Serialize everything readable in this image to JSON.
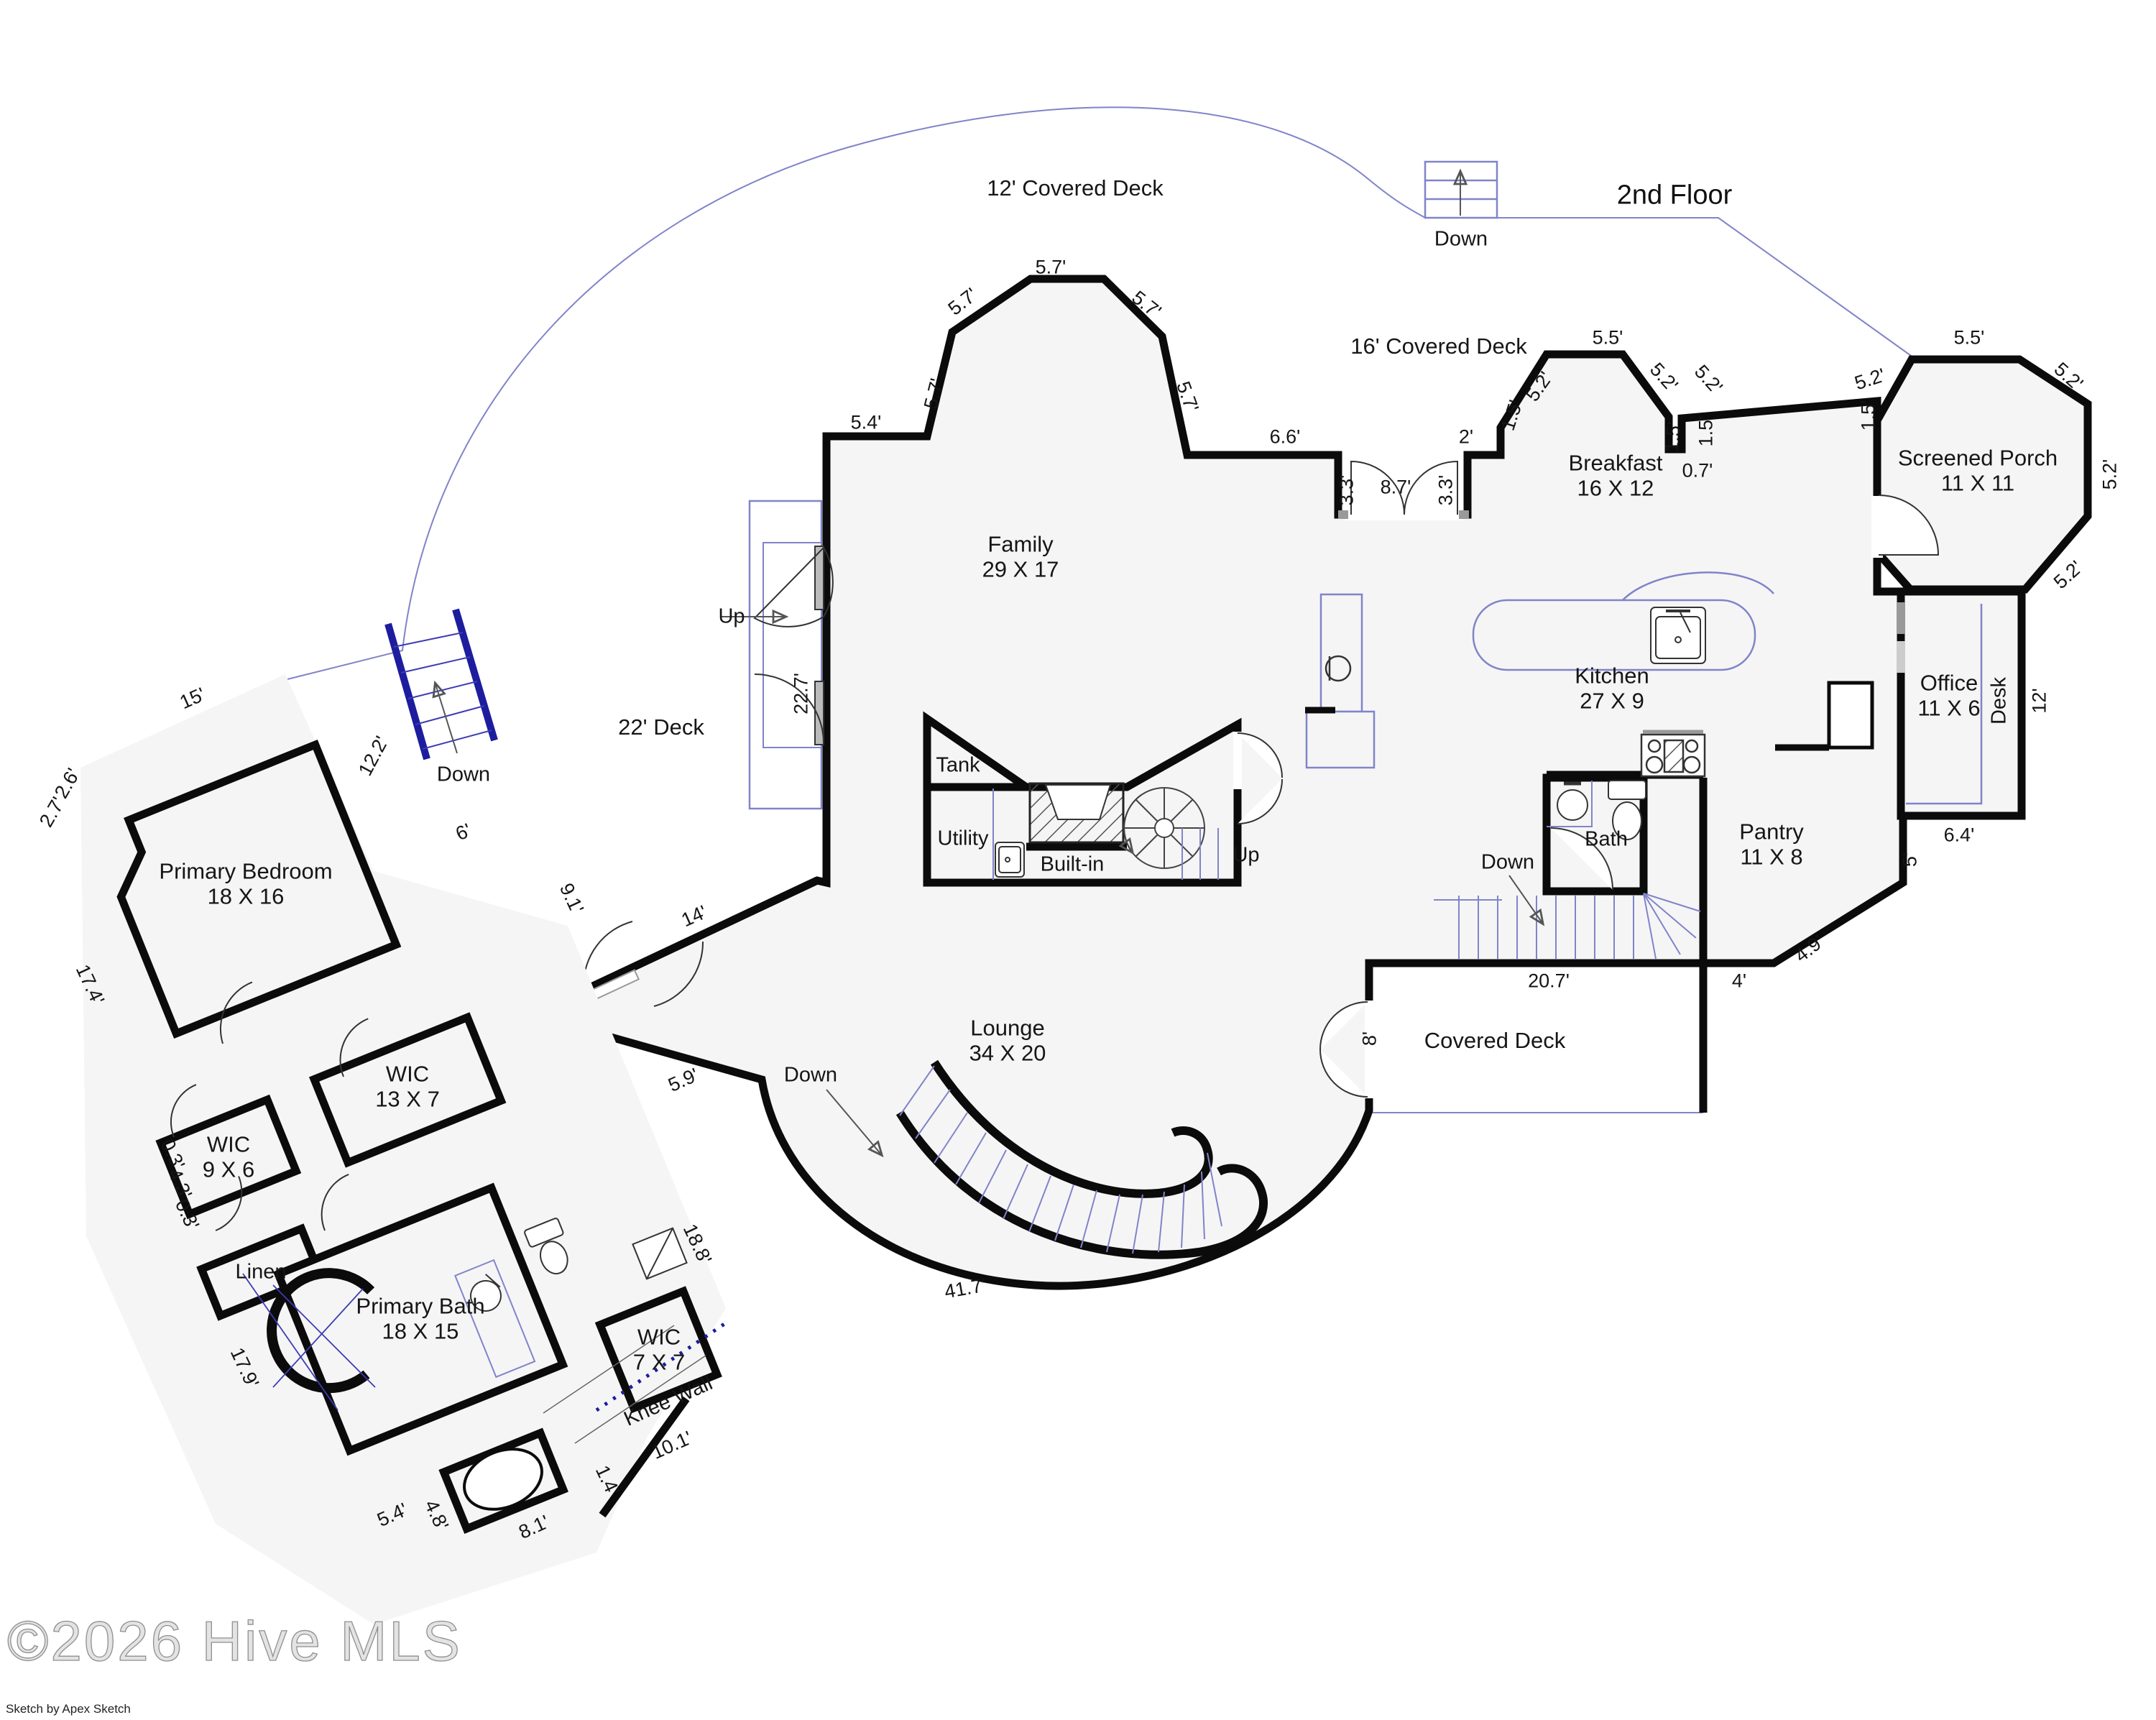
{
  "title": "2nd Floor",
  "watermark": "©2026 Hive MLS",
  "credit": "Sketch by Apex Sketch",
  "rooms": [
    {
      "name": "Family",
      "size": "29 X 17"
    },
    {
      "name": "Breakfast",
      "size": "16 X 12"
    },
    {
      "name": "Screened Porch",
      "size": "11 X 11"
    },
    {
      "name": "Kitchen",
      "size": "27 X 9"
    },
    {
      "name": "Office",
      "size": "11 X 6"
    },
    {
      "name": "Pantry",
      "size": "11 X 8"
    },
    {
      "name": "Lounge",
      "size": "34 X 20"
    },
    {
      "name": "Primary Bedroom",
      "size": "18 X 16"
    },
    {
      "name": "WIC",
      "size": "13 X 7"
    },
    {
      "name": "WIC",
      "size": "9 X 6"
    },
    {
      "name": "Primary Bath",
      "size": "18 X 15"
    },
    {
      "name": "WIC",
      "size": "7 X 7"
    }
  ],
  "areas": [
    "12' Covered Deck",
    "16' Covered Deck",
    "22' Deck",
    "Covered Deck"
  ],
  "labels": {
    "up": "Up",
    "down": "Down",
    "tank": "Tank",
    "utility": "Utility",
    "built_in": "Built-in",
    "bath": "Bath",
    "linen": "Linen",
    "desk": "Desk",
    "knee_wall": "Knee Wall"
  },
  "dims": [
    "5.7'",
    "5.7'",
    "5.7'",
    "5.7'",
    "5.7'",
    "5.4'",
    "6.6'",
    "2'",
    "8.7'",
    "3.3'",
    "3.3'",
    "1.5'",
    "5.2'",
    "5.5'",
    "5.2'",
    "5.2'",
    "1.5'",
    "1.5'",
    "0.7'",
    "5.2'",
    "1.5'",
    "5.5'",
    "5.2'",
    "5.2'",
    "5.2'",
    "22.7'",
    "15'",
    "2.6'",
    "2.7'",
    "12.2'",
    "17.4'",
    "6'",
    "9.1'",
    "14'",
    "5.9'",
    "0.3'",
    "4.3'",
    "0.3'",
    "17.9'",
    "18.8'",
    "10.1'",
    "1.4'",
    "5.4'",
    "4.8'",
    "8.1'",
    "41.7'",
    "20.7'",
    "4'",
    "4.9'",
    "5'",
    "6.4'",
    "12'",
    "8'"
  ],
  "colors": {
    "wall": "#0b0b0b",
    "deck_line": "#8084c8",
    "stair_blue": "#1d1d9e",
    "fill": "#f5f5f6"
  }
}
